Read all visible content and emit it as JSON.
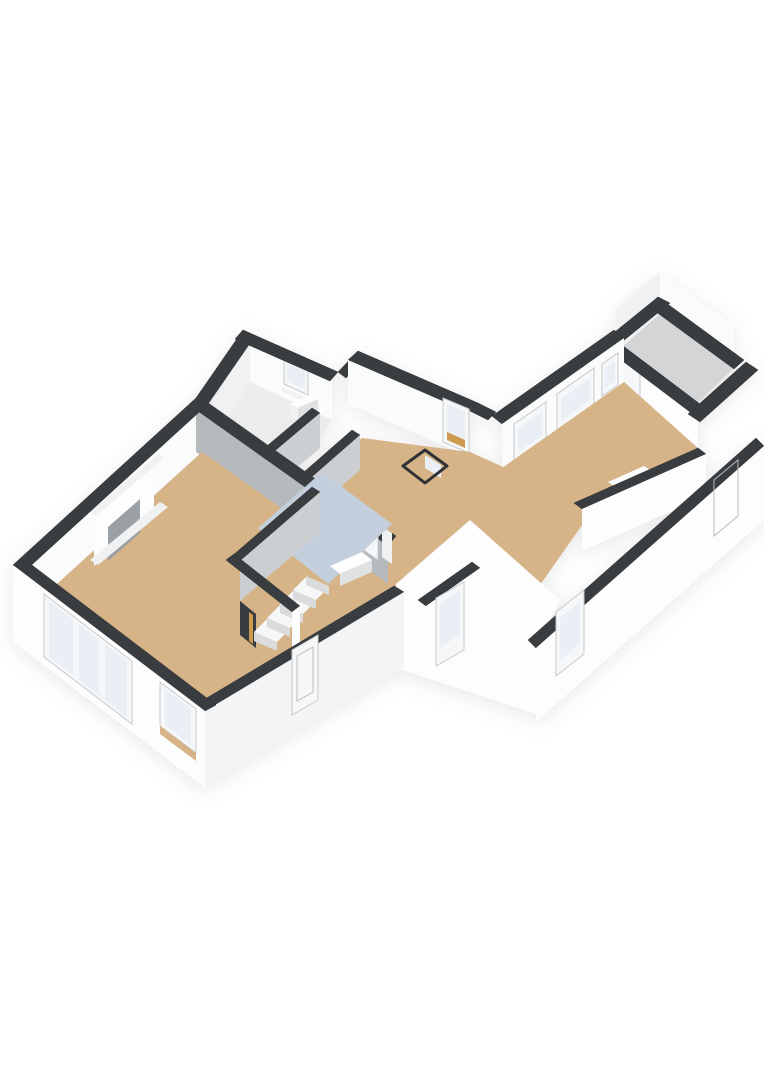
{
  "page": {
    "background": "#ffffff",
    "view": "3d-floorplan-axonometric"
  },
  "colors": {
    "wall_top": "#3a3d40",
    "face_lit": "#fafbfb",
    "face_soft": "#eff1f2",
    "face_shade": "#dfe1e3",
    "face_gray": "#b7babd",
    "face_gray_soft": "#cccfd1",
    "ext_white": "#fdfdfe",
    "ext_shade": "#f3f4f5",
    "floor_tan": "#d7b488",
    "floor_blue": "#c3cfdd",
    "floor_pale": "#ebecec",
    "floor_storage": "#d4d5d6",
    "glass": "#e9eff4",
    "door_white": "#f6f7f8",
    "wood": "#cf9a4e",
    "stair_top": "#f6f7f7",
    "stair_front": "#d9dbdd",
    "fire_inner": "#9aa0a4",
    "outline": "#2f3235"
  },
  "scene": {
    "rooms": [
      {
        "id": "living-room",
        "floor_color": "#d7b488"
      },
      {
        "id": "kitchen-zone",
        "floor_color": "#c3cfdd"
      },
      {
        "id": "hall",
        "floor_color": "#d7b488"
      },
      {
        "id": "toilet",
        "floor_color": "#ebecec"
      },
      {
        "id": "shower-room",
        "floor_color": "#ebecec"
      },
      {
        "id": "stair-closet",
        "floor_color": "#d7b488"
      },
      {
        "id": "bedroom",
        "floor_color": "#d7b488"
      },
      {
        "id": "storage-room",
        "floor_color": "#d4d5d6"
      },
      {
        "id": "rear-corridor",
        "floor_color": "#d7b488"
      }
    ],
    "features": [
      "fireplace",
      "staircase",
      "bay-window",
      "side-window",
      "front-door-glazed",
      "rear-doors-glazed",
      "floor-hatch-open",
      "toilet-sink",
      "kitchen-counter",
      "radiator",
      "storage-door",
      "bedroom-windows",
      "toilet-window"
    ]
  }
}
